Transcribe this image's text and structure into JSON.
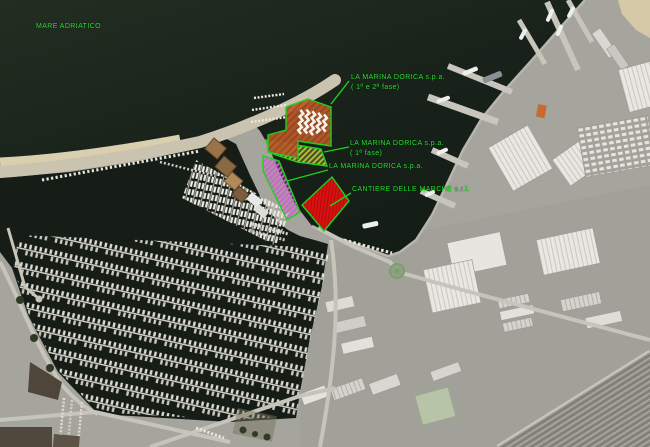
{
  "sea_label": "MARE ADRIATICO",
  "annotations": [
    {
      "label": "LA MARINA DORICA s.p.a.",
      "sublabel": "( 1ª e 2ª fase)"
    },
    {
      "label": "LA MARINA DORICA s.p.a.",
      "sublabel": "( 1ª fase)"
    },
    {
      "label": "LA MARINA DORICA s.p.a.",
      "sublabel": ""
    },
    {
      "label": "CANTIERE DELLE MARCHE s.r.l.",
      "sublabel": ""
    }
  ],
  "colors": {
    "annotation_text": "#25e02e",
    "leader_line": "#1fd01f",
    "outline_green": "#1fd01f",
    "area_phase12_fill": "#bb5a2a",
    "area_phase1_fill": "#b9c33a",
    "area_marina_fill": "#c966c9",
    "area_cantiere_fill": "#d91111"
  }
}
